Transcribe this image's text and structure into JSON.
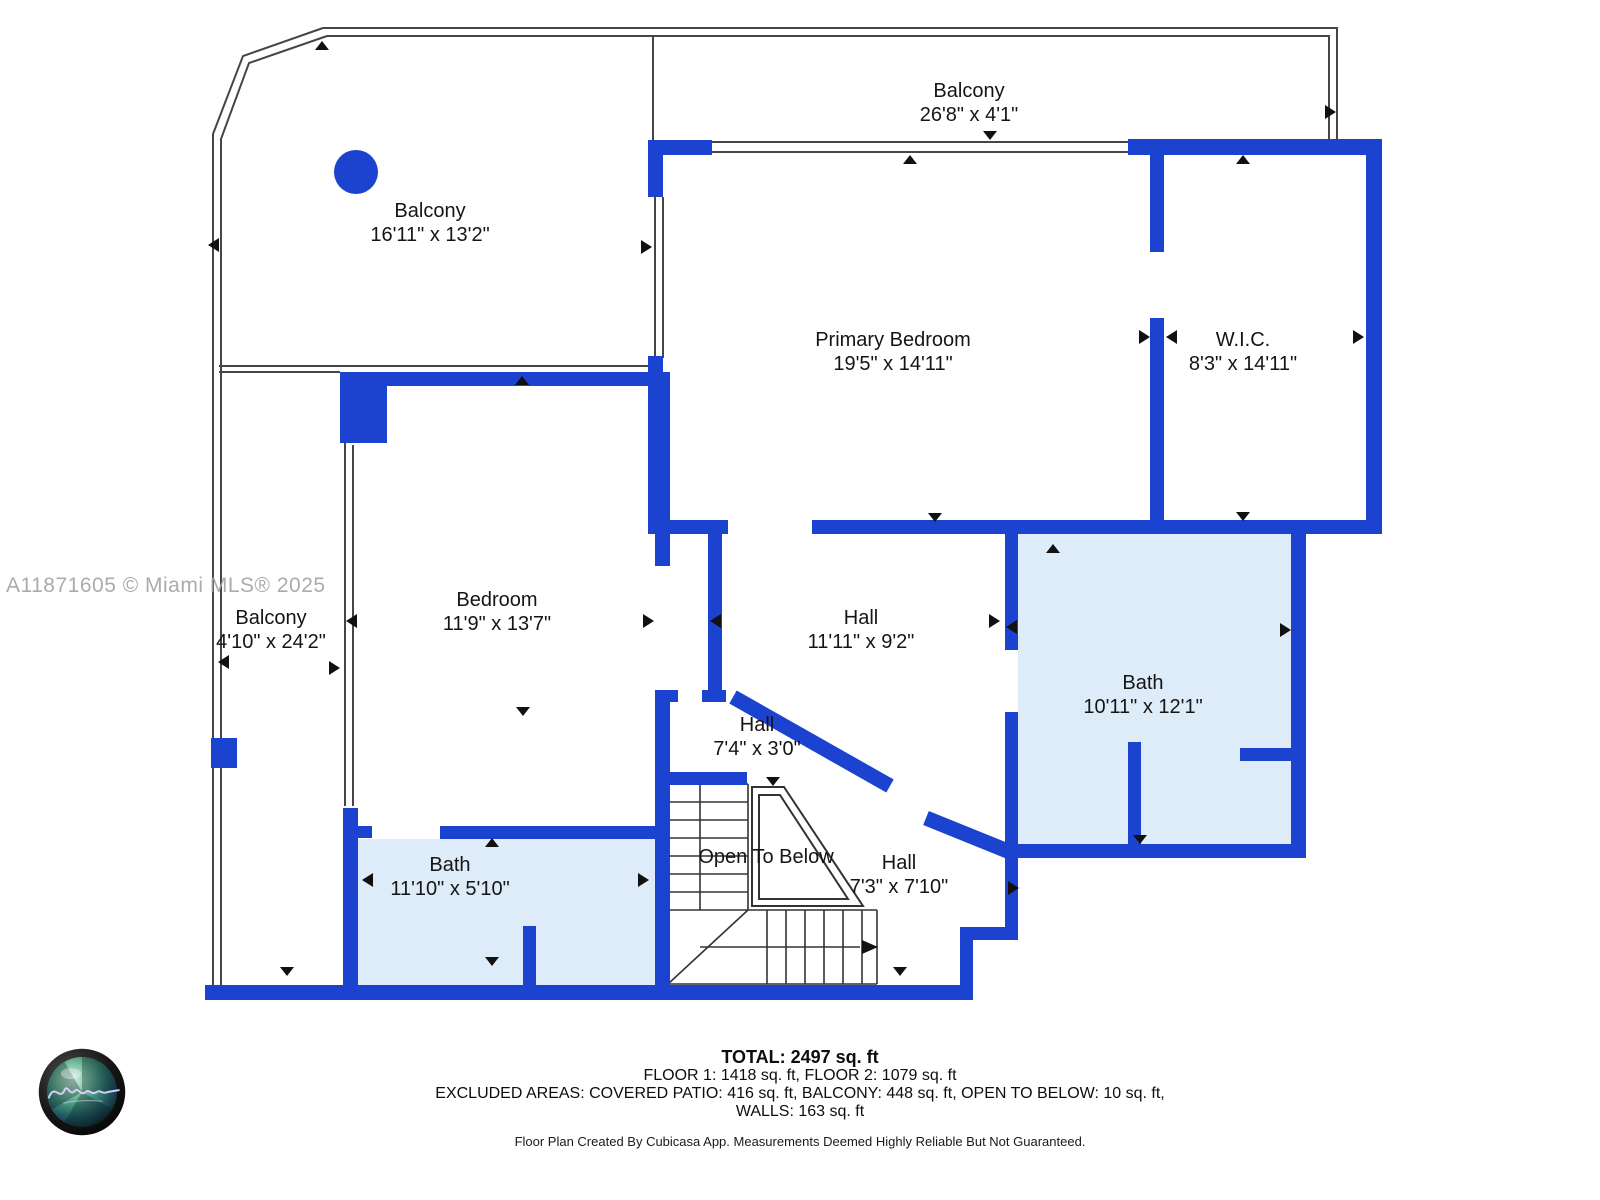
{
  "watermark": "A11871605 © Miami MLS® 2025",
  "rooms": [
    {
      "name": "Balcony",
      "dims": "16'11\" x 13'2\""
    },
    {
      "name": "Balcony",
      "dims": "26'8\" x 4'1\""
    },
    {
      "name": "Primary Bedroom",
      "dims": "19'5\" x 14'11\""
    },
    {
      "name": "W.I.C.",
      "dims": "8'3\" x 14'11\""
    },
    {
      "name": "Bedroom",
      "dims": "11'9\" x 13'7\""
    },
    {
      "name": "Balcony",
      "dims": "4'10\" x 24'2\""
    },
    {
      "name": "Hall",
      "dims": "11'11\" x 9'2\""
    },
    {
      "name": "Bath",
      "dims": "10'11\" x 12'1\""
    },
    {
      "name": "Hall",
      "dims": "7'4\" x 3'0\""
    },
    {
      "name": "Open To Below",
      "dims": ""
    },
    {
      "name": "Hall",
      "dims": "7'3\" x 7'10\""
    },
    {
      "name": "Bath",
      "dims": "11'10\" x 5'10\""
    }
  ],
  "footer": {
    "total": "TOTAL: 2497 sq. ft",
    "floors": "FLOOR 1: 1418 sq. ft, FLOOR 2: 1079 sq. ft",
    "excluded": "EXCLUDED AREAS: COVERED PATIO: 416 sq. ft, BALCONY: 448 sq. ft, OPEN TO BELOW: 10 sq. ft,",
    "walls": "WALLS: 163 sq. ft",
    "disclaimer": "Floor Plan Created By Cubicasa App. Measurements Deemed Highly Reliable But Not Guaranteed."
  },
  "colors": {
    "wall_blue": "#1b43cf",
    "bath_fill": "#ddecf8",
    "thin_line": "#454545",
    "stair_line": "#333333",
    "watermark_gray": "#a3a3a3"
  }
}
